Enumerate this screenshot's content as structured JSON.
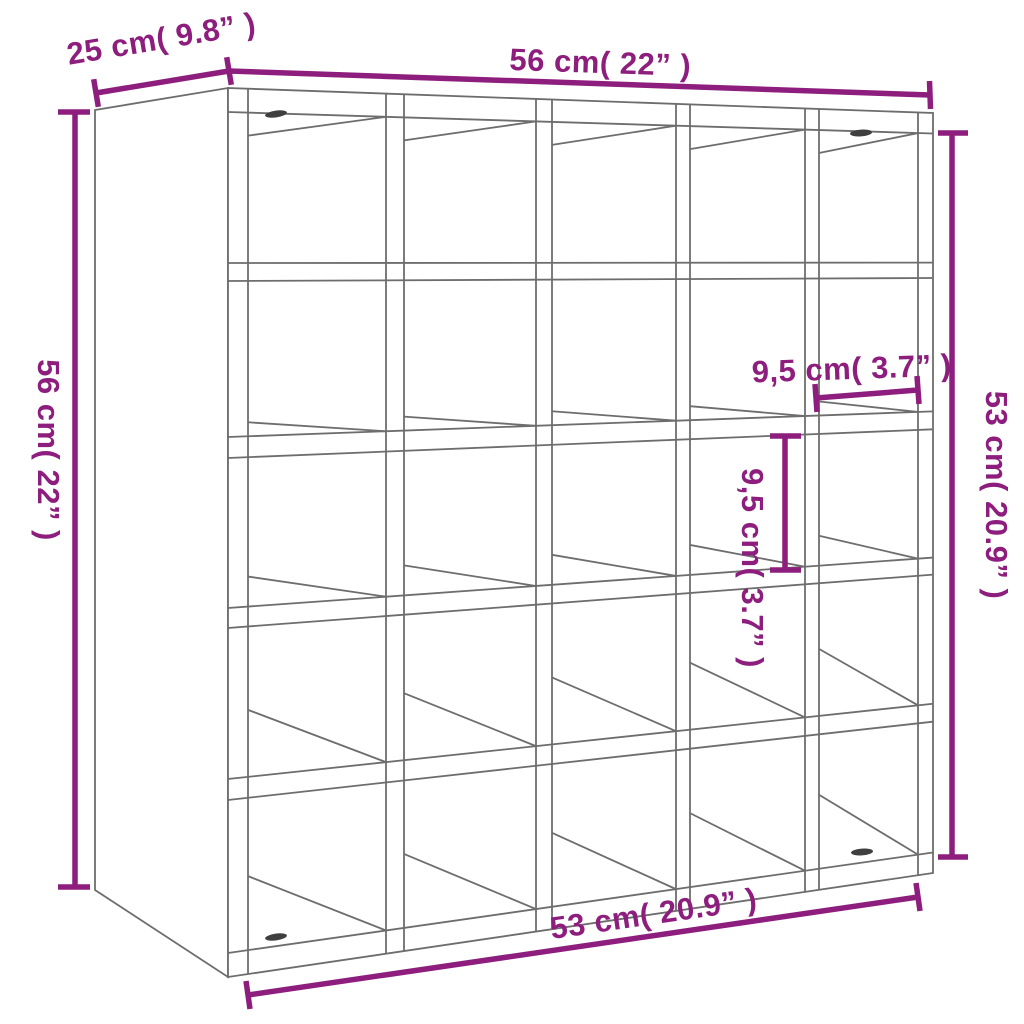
{
  "diagram": {
    "title": "wine-rack-cube-shelf-dimension-diagram",
    "grid": {
      "rows": 5,
      "cols": 5,
      "cubbies": 25
    },
    "colors": {
      "dimension": "#8d1e7d",
      "outline": "#6d6d6d",
      "screw": "#3f3f3f",
      "background": "#ffffff"
    },
    "icons": {
      "screws": "cam-lock-screw-icon"
    },
    "dimensions": {
      "depth_top_left": {
        "label": "25 cm( 9.8” )",
        "cm": "25",
        "inch": "9.8"
      },
      "width_top": {
        "label": "56 cm( 22” )",
        "cm": "56",
        "inch": "22"
      },
      "height_left": {
        "label": "56 cm( 22” )",
        "cm": "56",
        "inch": "22"
      },
      "height_right": {
        "label": "53 cm( 20.9” )",
        "cm": "53",
        "inch": "20.9"
      },
      "width_bottom": {
        "label": "53 cm( 20.9” )",
        "cm": "53",
        "inch": "20.9"
      },
      "cell_width": {
        "label": "9,5 cm( 3.7” )",
        "cm": "9,5",
        "inch": "3.7"
      },
      "cell_height": {
        "label": "9,5 cm( 3.7” )",
        "cm": "9,5",
        "inch": "3.7"
      }
    }
  }
}
